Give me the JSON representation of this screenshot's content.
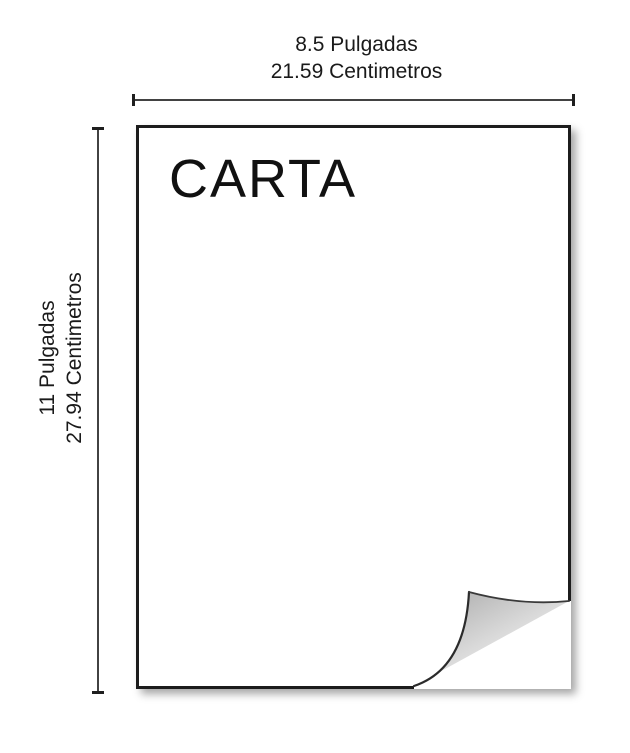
{
  "diagram": {
    "paper_title": "CARTA",
    "width_dimension": {
      "line1": "8.5 Pulgadas",
      "line2": "21.59 Centimetros"
    },
    "height_dimension": {
      "line1": "11 Pulgadas",
      "line2": "27.94 Centimetros"
    }
  },
  "colors": {
    "text-color": "#1a1a1a",
    "line-color": "#424242",
    "tick-color": "#1f1f1f",
    "border-color": "#1c1c1c",
    "curl-shade": "#bdbdbd"
  }
}
